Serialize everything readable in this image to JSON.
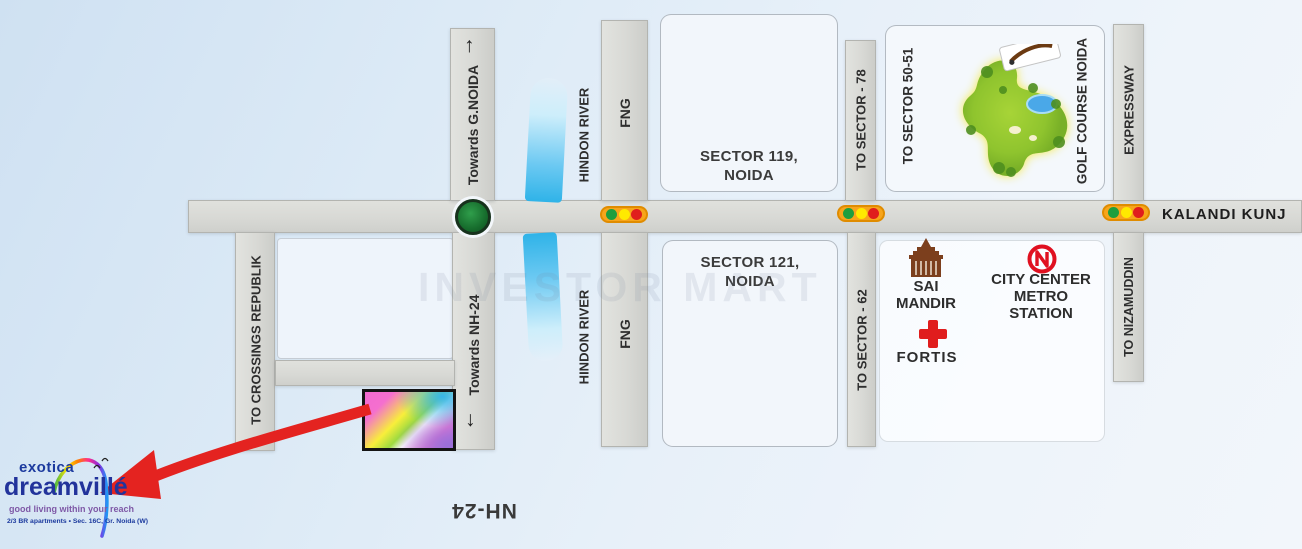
{
  "watermark": "INVESTOR MART",
  "roads": {
    "kalandi_kunj": "KALANDI KUNJ",
    "towards_gnoida": "Towards G.NOIDA",
    "towards_nh24": "Towards NH-24",
    "crossings_republik": "TO CROSSINGS REPUBLIK",
    "fng": "FNG",
    "sector_78": "TO SECTOR - 78",
    "sector_62": "TO SECTOR - 62",
    "expressway": "EXPRESSWAY",
    "nizamuddin": "TO NIZAMUDDIN",
    "nh24": "NH-24",
    "arrow_up": "↑",
    "arrow_down": "↓"
  },
  "river": {
    "label": "HINDON RIVER"
  },
  "sectors": {
    "s119_line1": "SECTOR 119,",
    "s119_line2": "NOIDA",
    "s121_line1": "SECTOR 121,",
    "s121_line2": "NOIDA"
  },
  "golf": {
    "to_sector": "TO SECTOR 50-51",
    "name": "GOLF COURSE NOIDA"
  },
  "landmarks": {
    "sai_line1": "SAI",
    "sai_line2": "MANDIR",
    "metro_line1": "CITY CENTER",
    "metro_line2": "METRO",
    "metro_line3": "STATION",
    "fortis": "FORTIS"
  },
  "logo": {
    "brand_top": "exotica",
    "brand_main": "dreamvillé",
    "tagline": "good living within your reach",
    "subline": "2/3 BR apartments • Sec. 16C, Gr. Noida (W)"
  },
  "colors": {
    "road": "#d8d9d5",
    "river_blue": "#2fb3e8",
    "accent_red": "#e42320",
    "brand_blue": "#1c3a9e",
    "golf_green": "#8fc42e",
    "traffic_pill": "#f7a51b"
  }
}
